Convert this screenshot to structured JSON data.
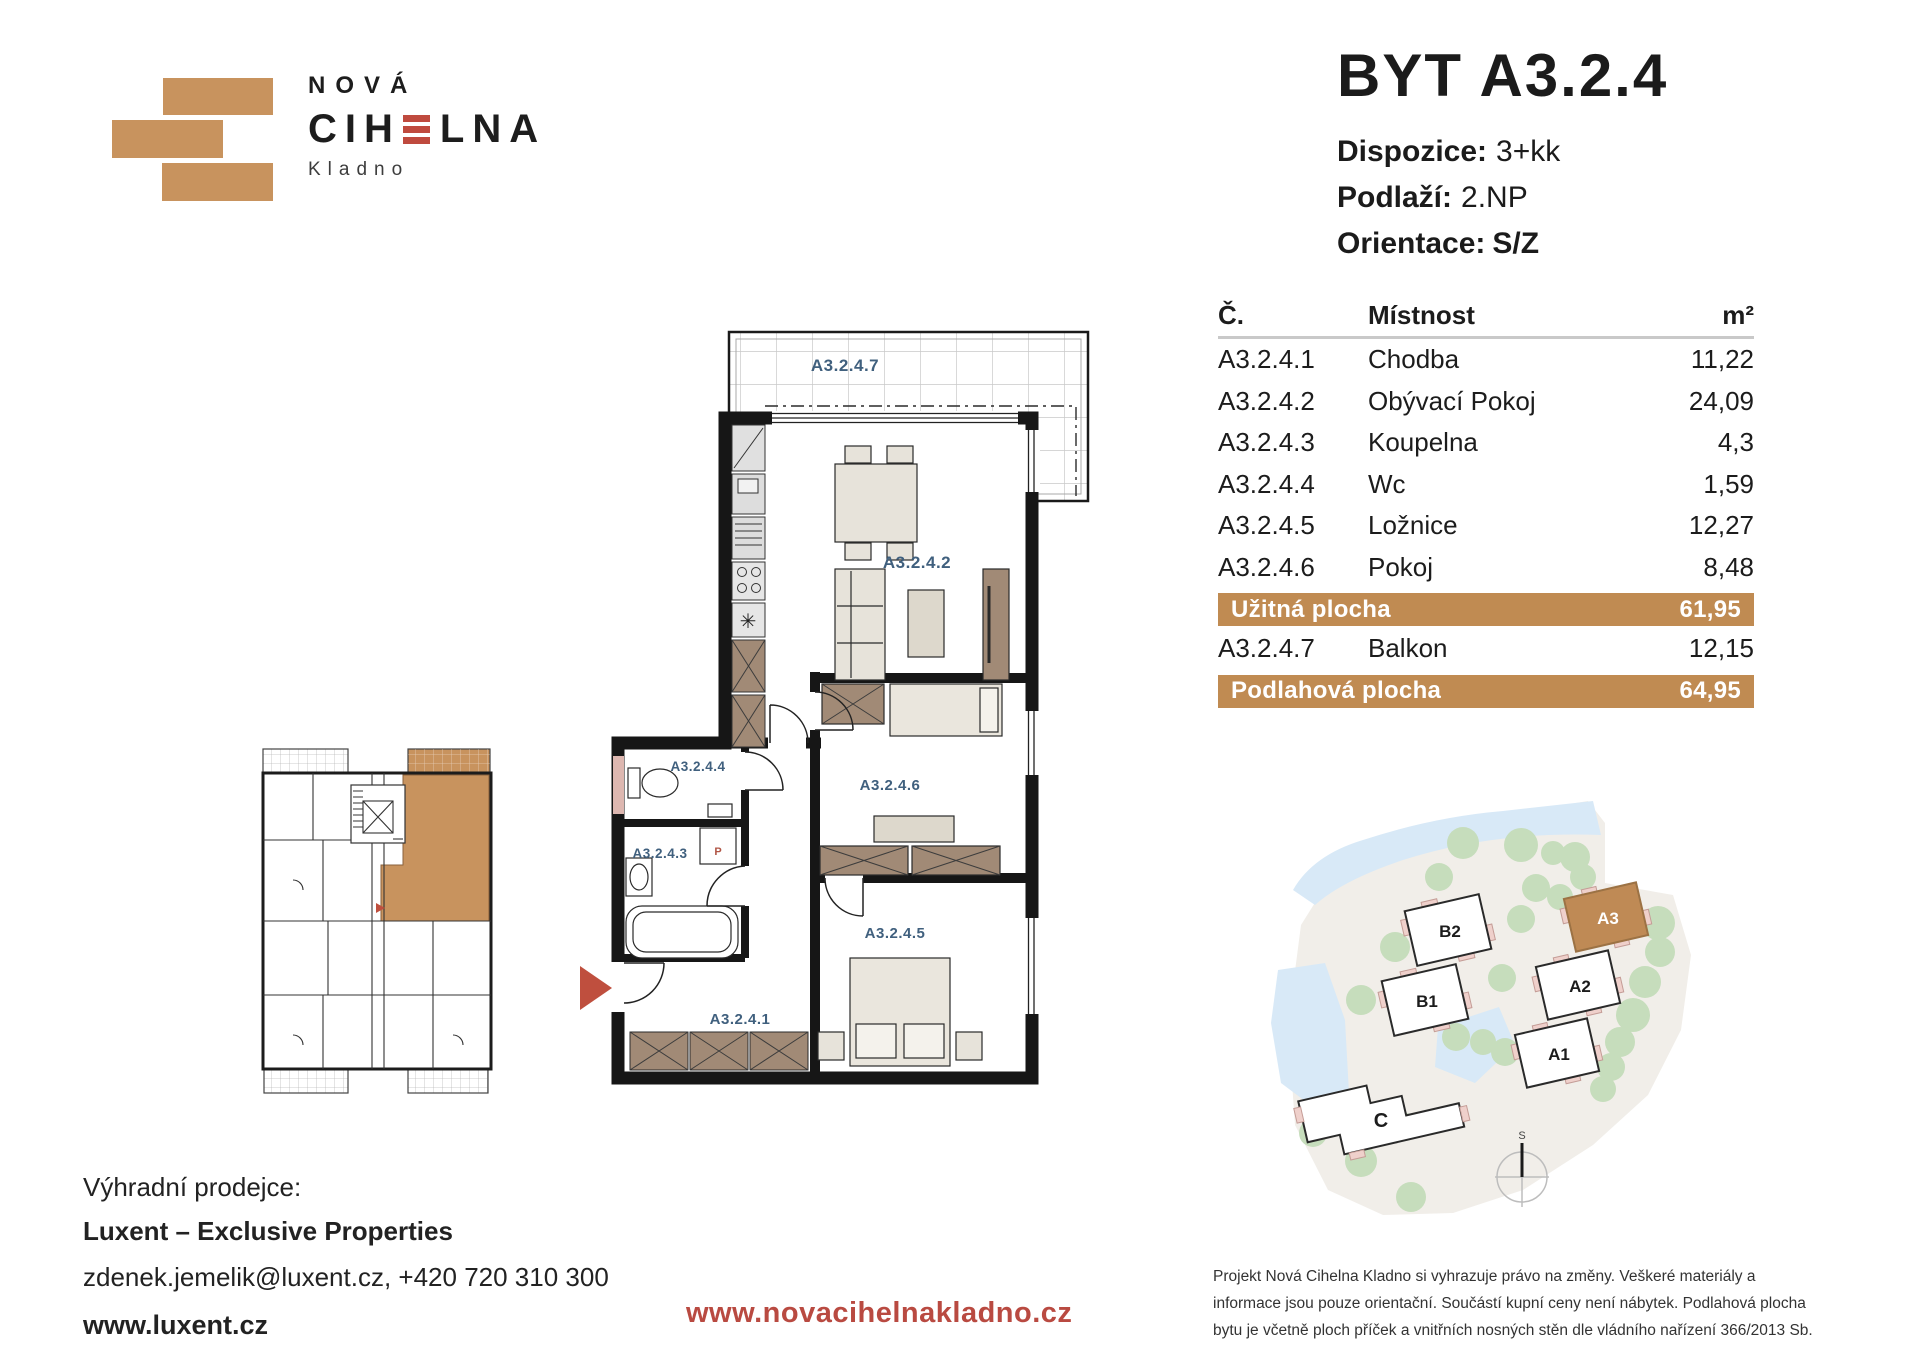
{
  "logo": {
    "line1": "NOVÁ",
    "brand_pre": "CIH",
    "brand_post": "LNA",
    "city": "Kladno"
  },
  "title": {
    "heading": "BYT A3.2.4",
    "specs": [
      {
        "label": "Dispozice:",
        "value": "3+kk"
      },
      {
        "label": "Podlaží:",
        "value": "2.NP"
      },
      {
        "label": "Orientace:",
        "value": "S/Z"
      }
    ]
  },
  "table": {
    "headers": {
      "number": "Č.",
      "room": "Místnost",
      "area": "m²"
    },
    "rooms": [
      {
        "number": "A3.2.4.1",
        "room": "Chodba",
        "area": "11,22"
      },
      {
        "number": "A3.2.4.2",
        "room": "Obývací Pokoj",
        "area": "24,09"
      },
      {
        "number": "A3.2.4.3",
        "room": "Koupelna",
        "area": "4,3"
      },
      {
        "number": "A3.2.4.4",
        "room": "Wc",
        "area": "1,59"
      },
      {
        "number": "A3.2.4.5",
        "room": "Ložnice",
        "area": "12,27"
      },
      {
        "number": "A3.2.4.6",
        "room": "Pokoj",
        "area": "8,48"
      }
    ],
    "usable": {
      "label": "Užitná plocha",
      "value": "61,95"
    },
    "balcony_row": {
      "number": "A3.2.4.7",
      "room": "Balkon",
      "area": "12,15"
    },
    "floor": {
      "label": "Podlahová plocha",
      "value": "64,95"
    }
  },
  "plan": {
    "labels": {
      "balcony": "A3.2.4.7",
      "living": "A3.2.4.2",
      "wc": "A3.2.4.4",
      "bath": "A3.2.4.3",
      "room": "A3.2.4.6",
      "bedroom": "A3.2.4.5",
      "hall": "A3.2.4.1",
      "washer": "P"
    }
  },
  "site": {
    "buildings": [
      {
        "id": "B2"
      },
      {
        "id": "B1"
      },
      {
        "id": "A3"
      },
      {
        "id": "A2"
      },
      {
        "id": "A1"
      },
      {
        "id": "C"
      }
    ],
    "compass": "S"
  },
  "footer": {
    "seller_label": "Výhradní prodejce:",
    "seller_name": "Luxent – Exclusive Properties",
    "contact": "zdenek.jemelik@luxent.cz, +420 720 310 300",
    "seller_url": "www.luxent.cz",
    "project_url": "www.novacihelnakladno.cz",
    "disclaimer": "Projekt Nová Cihelna Kladno si vyhrazuje právo na změny. Veškeré materiály a informace jsou pouze orientační. Součástí kupní ceny není nábytek. Podlahová plocha bytu je včetně ploch příček a vnitřních nosných stěn dle vládního nařízení 366/2013 Sb."
  },
  "colors": {
    "brand-tan": "#c8935e",
    "brand-red": "#bf4a3e",
    "band-bg": "#c08b52",
    "url-red": "#b94a41",
    "plan-label": "#40607e",
    "site-a3": "#bf8a55",
    "arrow-red": "#bf4f3e"
  }
}
